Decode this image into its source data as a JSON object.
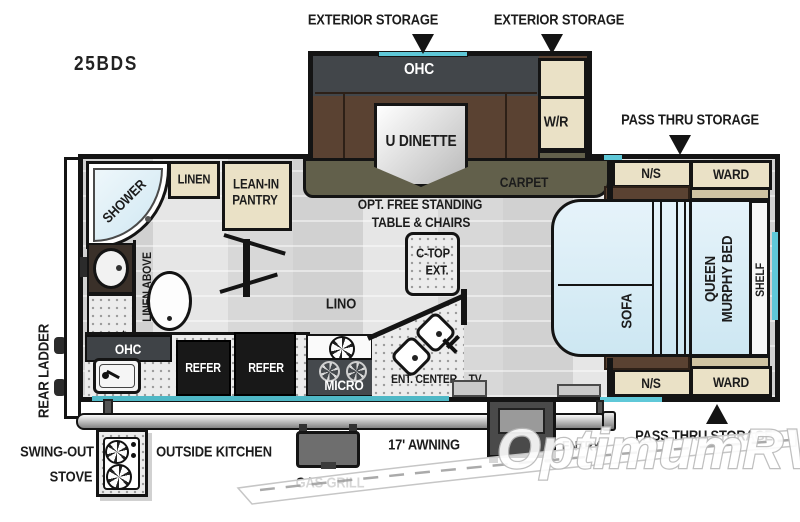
{
  "model": "25BDS",
  "callouts": {
    "exterior_storage_1": "EXTERIOR STORAGE",
    "exterior_storage_2": "EXTERIOR STORAGE",
    "pass_thru_top": "PASS THRU STORAGE",
    "pass_thru_bottom": "PASS THRU STORAGE"
  },
  "slideout": {
    "ohc": "OHC",
    "dinette": "U DINETTE",
    "wardrobe_robe": "W/R"
  },
  "living": {
    "carpet": "CARPET",
    "opt_table_line1": "OPT. FREE STANDING",
    "opt_table_line2": "TABLE & CHAIRS",
    "ctop_line1": "C-TOP",
    "ctop_line2": "EXT.",
    "lino": "LINO"
  },
  "bath": {
    "shower": "SHOWER",
    "linen": "LINEN",
    "linen_above": "LINEN ABOVE",
    "pantry_line1": "LEAN-IN",
    "pantry_line2": "PANTRY"
  },
  "kitchen": {
    "ohc": "OHC",
    "refer1": "REFER",
    "refer2": "REFER",
    "micro": "MICRO",
    "ent_center": "ENT. CENTER",
    "tv": "TV"
  },
  "bedroom": {
    "ns_top": "N/S",
    "ward_top": "WARD",
    "ns_bottom": "N/S",
    "ward_bottom": "WARD",
    "sofa": "SOFA",
    "bed_line1": "QUEEN",
    "bed_line2": "MURPHY BED",
    "shelf": "SHELF"
  },
  "exterior": {
    "rear_ladder": "REAR LADDER",
    "swing_out_line1": "SWING-OUT",
    "swing_out_line2": "STOVE",
    "outside_kitchen": "OUTSIDE KITCHEN",
    "gas_grill": "GAS GRILL",
    "awning": "17' AWNING",
    "entry": "ENTRY"
  },
  "watermark": {
    "brand": "OptimumRV"
  },
  "colors": {
    "window_cyan": "#5fc8d8",
    "carpet_olive": "#62604b",
    "cushion_brown": "#5a4232",
    "cabinet_cream": "#eae1c6",
    "bed_blue": "#ddeef7"
  }
}
